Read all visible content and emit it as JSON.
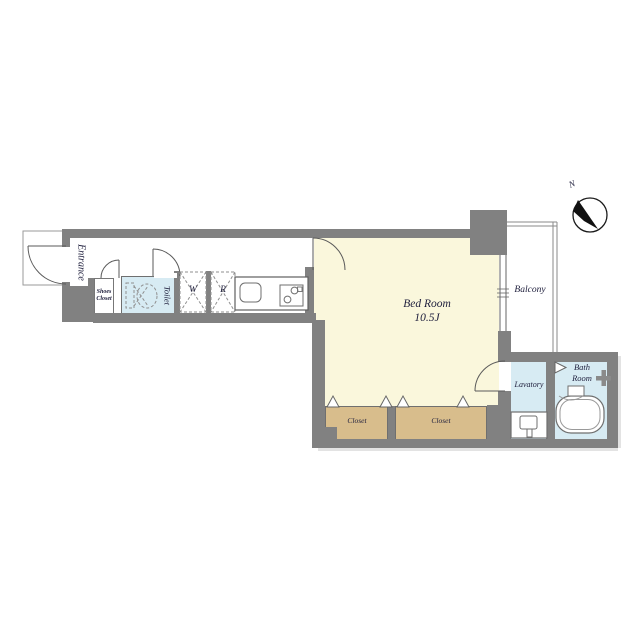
{
  "floor_plan": {
    "title": "studio apartment floor plan",
    "rooms": {
      "entrance": {
        "label": "Entrance"
      },
      "shoes_closet": {
        "line1": "Shoes",
        "line2": "Closet"
      },
      "toilet": {
        "label": "Toilet"
      },
      "washer": {
        "label": "W"
      },
      "fridge": {
        "label": "R"
      },
      "bed_room": {
        "label": "Bed Room",
        "size": "10.5J"
      },
      "balcony": {
        "label": "Balcony"
      },
      "lavatory": {
        "label": "Lavatory"
      },
      "bath_room": {
        "line1": "Bath",
        "line2": "Room"
      },
      "closet_left": {
        "label": "Closet"
      },
      "closet_right": {
        "label": "Closet"
      }
    },
    "compass": {
      "north": "N"
    },
    "colors": {
      "wall": "#818181",
      "bedroom": "#FAF7DC",
      "wet": "#D7EBF3",
      "closet": "#D8BD8C"
    }
  }
}
